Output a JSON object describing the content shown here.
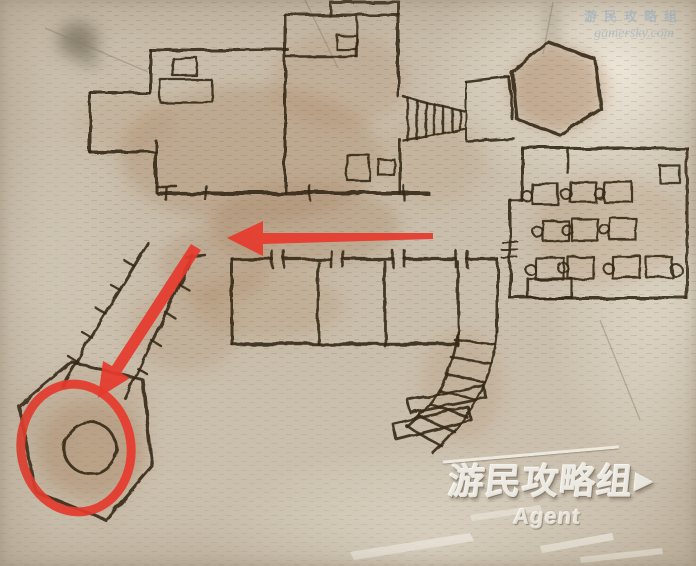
{
  "watermark_top": {
    "line1": "游民攻略组",
    "line2": "gamersky.com"
  },
  "watermark_bottom": {
    "title": "游民攻略组",
    "flag": "▶",
    "subtitle": "Agent"
  },
  "colors": {
    "parchment": "#cbc0ae",
    "ink": "#35281a",
    "stain_brown": "#a37b55",
    "annotation_red": "#e63a2c",
    "watermark_blue": "#94b4cf",
    "watermark_white": "#ece9e1"
  },
  "map": {
    "ink": "#35281a",
    "stains": [
      {
        "cx": 250,
        "cy": 155,
        "rx": 130,
        "ry": 70,
        "c": "#a37b55",
        "o": 0.3
      },
      {
        "cx": 305,
        "cy": 225,
        "rx": 95,
        "ry": 42,
        "c": "#a37b55",
        "o": 0.3
      },
      {
        "cx": 215,
        "cy": 265,
        "rx": 55,
        "ry": 38,
        "c": "#a37b55",
        "o": 0.28
      },
      {
        "cx": 340,
        "cy": 80,
        "rx": 70,
        "ry": 48,
        "c": "#ab835c",
        "o": 0.24
      },
      {
        "cx": 558,
        "cy": 88,
        "rx": 50,
        "ry": 42,
        "c": "#a37b55",
        "o": 0.3
      },
      {
        "cx": 610,
        "cy": 230,
        "rx": 75,
        "ry": 55,
        "c": "#ab835c",
        "o": 0.2
      },
      {
        "cx": 92,
        "cy": 448,
        "rx": 52,
        "ry": 48,
        "c": "#a37b55",
        "o": 0.33
      },
      {
        "cx": 185,
        "cy": 330,
        "rx": 55,
        "ry": 42,
        "c": "#a37b55",
        "o": 0.2
      },
      {
        "cx": 462,
        "cy": 385,
        "rx": 40,
        "ry": 55,
        "c": "#ab835c",
        "o": 0.2
      },
      {
        "cx": 268,
        "cy": 305,
        "rx": 75,
        "ry": 35,
        "c": "#a88058",
        "o": 0.22
      },
      {
        "cx": 125,
        "cy": 122,
        "rx": 48,
        "ry": 32,
        "c": "#ab835c",
        "o": 0.18
      },
      {
        "cx": 430,
        "cy": 160,
        "rx": 55,
        "ry": 45,
        "c": "#b08a62",
        "o": 0.18
      },
      {
        "cx": 78,
        "cy": 40,
        "rx": 20,
        "ry": 18,
        "c": "#6e6556",
        "o": 0.65
      },
      {
        "cx": 90,
        "cy": 60,
        "rx": 9,
        "ry": 7,
        "c": "#6e6556",
        "o": 0.5
      },
      {
        "cx": 551,
        "cy": 25,
        "rx": 6,
        "ry": 26,
        "c": "#7a6d59",
        "o": 0.4
      }
    ],
    "fills": [
      {
        "d": "M548,42 L595,59 L601,109 L560,135 L517,119 L512,72 Z",
        "color": "#a98565",
        "opacity": 0.28
      },
      {
        "d": "M72,362 L143,380 L152,466 L106,520 L36,492 L19,406 Z",
        "color": "#a98565",
        "opacity": 0.22
      }
    ],
    "creases": [
      {
        "d": "M305,0 L338,68"
      },
      {
        "d": "M553,2 L543,54"
      },
      {
        "d": "M45,28 L148,72"
      },
      {
        "d": "M600,320 L640,420"
      }
    ],
    "strokes": [
      {
        "d": "M150,50 L288,50"
      },
      {
        "d": "M150,50 L150,93"
      },
      {
        "d": "M90,93 L150,93"
      },
      {
        "d": "M90,93 L90,152"
      },
      {
        "d": "M90,152 L156,152"
      },
      {
        "d": "M156,141 L156,192"
      },
      {
        "d": "M156,186 L176,186",
        "w": 2.4
      },
      {
        "d": "M285,15 L398,15"
      },
      {
        "d": "M285,15 L285,193"
      },
      {
        "d": "M330,15 L330,2 L399,2 L399,15"
      },
      {
        "d": "M287,57 L357,57",
        "w": 2.6
      },
      {
        "d": "M357,17 L357,57",
        "w": 2.6
      },
      {
        "d": "M398,15 L398,96"
      },
      {
        "d": "M400,140 L400,193"
      },
      {
        "d": "M158,193 L428,193",
        "w": 4
      },
      {
        "d": "M166,186 L166,200",
        "w": 2.4
      },
      {
        "d": "M206,186 L206,200",
        "w": 2.4
      },
      {
        "d": "M310,186 L310,200",
        "w": 2.4
      },
      {
        "d": "M404,186 L404,200",
        "w": 2.4
      },
      {
        "d": "M404,97 L464,111",
        "w": 2.4
      },
      {
        "d": "M404,141 L464,129",
        "w": 2.4
      },
      {
        "d": "M408,98 L408,141",
        "w": 2.4
      },
      {
        "d": "M417,100 L417,139",
        "w": 2.4
      },
      {
        "d": "M426,102 L426,137",
        "w": 2.4
      },
      {
        "d": "M434,104 L434,135",
        "w": 2.4
      },
      {
        "d": "M443,106 L443,133",
        "w": 2.4
      },
      {
        "d": "M452,108 L452,131",
        "w": 2.4
      },
      {
        "d": "M460,110 L460,129",
        "w": 2.4
      },
      {
        "d": "M466,82 L509,77",
        "w": 2.6
      },
      {
        "d": "M509,77 L513,120",
        "w": 2.6
      },
      {
        "d": "M468,141 L513,138",
        "w": 2.6
      },
      {
        "d": "M466,82 L466,141",
        "w": 2
      },
      {
        "d": "M548,42 L595,59 L601,109 L560,135 L517,119 L512,72 Z",
        "w": 3.4
      },
      {
        "d": "M522,148 L687,148"
      },
      {
        "d": "M687,148 L687,298"
      },
      {
        "d": "M510,298 L687,298"
      },
      {
        "d": "M522,148 L522,200"
      },
      {
        "d": "M510,200 L522,200",
        "w": 2.6
      },
      {
        "d": "M510,200 L510,298"
      },
      {
        "d": "M568,148 L568,173",
        "w": 2.6
      },
      {
        "d": "M502,242 L518,242",
        "w": 2
      },
      {
        "d": "M502,250 L518,250",
        "w": 2
      },
      {
        "d": "M502,258 L518,258",
        "w": 2
      },
      {
        "d": "M232,259 L272,259",
        "w": 3.2
      },
      {
        "d": "M284,259 L331,259",
        "w": 3.2
      },
      {
        "d": "M343,259 L393,259",
        "w": 3.2
      },
      {
        "d": "M405,259 L456,259",
        "w": 3.2
      },
      {
        "d": "M467,259 L497,259",
        "w": 3.2
      },
      {
        "d": "M272,251 L272,267",
        "w": 2.6
      },
      {
        "d": "M284,251 L284,267",
        "w": 2.6
      },
      {
        "d": "M331,251 L331,267",
        "w": 2.6
      },
      {
        "d": "M343,251 L343,267",
        "w": 2.6
      },
      {
        "d": "M393,251 L393,267",
        "w": 2.6
      },
      {
        "d": "M405,251 L405,267",
        "w": 2.6
      },
      {
        "d": "M456,251 L456,267",
        "w": 2.6
      },
      {
        "d": "M467,251 L467,267",
        "w": 2.6
      },
      {
        "d": "M232,259 L232,344"
      },
      {
        "d": "M232,344 L458,344",
        "w": 3.4
      },
      {
        "d": "M318,262 L318,344",
        "w": 2.8
      },
      {
        "d": "M385,262 L385,346",
        "w": 2.8
      },
      {
        "d": "M458,262 L458,346",
        "w": 2.8
      },
      {
        "d": "M497,259 L497,332"
      },
      {
        "d": "M458,332 C454,365 441,398 407,427",
        "w": 2.6
      },
      {
        "d": "M497,332 C494,372 477,412 433,453",
        "w": 2.6
      },
      {
        "d": "M455,340 L495,344",
        "w": 2.6
      },
      {
        "d": "M451,357 L491,363",
        "w": 2.6
      },
      {
        "d": "M446,374 L485,382",
        "w": 2.6
      },
      {
        "d": "M439,390 L477,400",
        "w": 2.6
      },
      {
        "d": "M430,404 L467,417",
        "w": 2.6
      },
      {
        "d": "M419,416 L455,432",
        "w": 2.6
      },
      {
        "d": "M407,426 L441,446",
        "w": 2.6
      },
      {
        "d": "M408,400 L483,385 L486,398 L411,413 Z",
        "w": 2.8
      },
      {
        "d": "M393,424 L468,407 L471,420 L396,439 Z",
        "w": 2.8
      },
      {
        "d": "M148,243 L62,386",
        "w": 3
      },
      {
        "d": "M134,266 L124,260",
        "w": 2.4
      },
      {
        "d": "M120,290 L110,284",
        "w": 2.4
      },
      {
        "d": "M106,314 L96,308",
        "w": 2.4
      },
      {
        "d": "M92,338 L82,332",
        "w": 2.4
      },
      {
        "d": "M78,362 L68,356",
        "w": 2.4
      },
      {
        "d": "M193,256 L125,398",
        "w": 3
      },
      {
        "d": "M179,284 L189,290",
        "w": 2.4
      },
      {
        "d": "M165,312 L175,318",
        "w": 2.4
      },
      {
        "d": "M151,340 L161,346",
        "w": 2.4
      },
      {
        "d": "M137,368 L147,374",
        "w": 2.4
      },
      {
        "d": "M186,258 L206,256",
        "w": 2.4
      },
      {
        "d": "M72,362 L143,380 L152,466 L106,520 L36,492 L19,406 Z",
        "w": 3.2
      }
    ],
    "rects": [
      {
        "x": 173,
        "y": 58,
        "w": 24,
        "h": 18
      },
      {
        "x": 160,
        "y": 80,
        "w": 52,
        "h": 22
      },
      {
        "x": 337,
        "y": 35,
        "w": 20,
        "h": 15
      },
      {
        "x": 347,
        "y": 155,
        "w": 22,
        "h": 25
      },
      {
        "x": 378,
        "y": 159,
        "w": 16,
        "h": 16
      },
      {
        "x": 532,
        "y": 184,
        "w": 26,
        "h": 20
      },
      {
        "x": 570,
        "y": 182,
        "w": 26,
        "h": 20
      },
      {
        "x": 604,
        "y": 182,
        "w": 28,
        "h": 20
      },
      {
        "x": 660,
        "y": 166,
        "w": 20,
        "h": 17
      },
      {
        "x": 543,
        "y": 221,
        "w": 26,
        "h": 20
      },
      {
        "x": 572,
        "y": 219,
        "w": 26,
        "h": 22
      },
      {
        "x": 610,
        "y": 218,
        "w": 26,
        "h": 22
      },
      {
        "x": 536,
        "y": 258,
        "w": 28,
        "h": 22
      },
      {
        "x": 568,
        "y": 257,
        "w": 26,
        "h": 22
      },
      {
        "x": 612,
        "y": 256,
        "w": 28,
        "h": 22
      },
      {
        "x": 646,
        "y": 257,
        "w": 26,
        "h": 20
      },
      {
        "x": 528,
        "y": 279,
        "w": 44,
        "h": 19
      }
    ],
    "circles": [
      {
        "cx": 90,
        "cy": 448,
        "r": 26,
        "w": 2.8
      },
      {
        "cx": 527,
        "cy": 196,
        "r": 5
      },
      {
        "cx": 566,
        "cy": 194,
        "r": 5
      },
      {
        "cx": 600,
        "cy": 194,
        "r": 5
      },
      {
        "cx": 538,
        "cy": 232,
        "r": 5
      },
      {
        "cx": 567,
        "cy": 230,
        "r": 5
      },
      {
        "cx": 605,
        "cy": 230,
        "r": 5
      },
      {
        "cx": 531,
        "cy": 270,
        "r": 5
      },
      {
        "cx": 563,
        "cy": 268,
        "r": 5
      },
      {
        "cx": 608,
        "cy": 268,
        "r": 5
      },
      {
        "cx": 676,
        "cy": 270,
        "r": 6
      }
    ],
    "tears": [
      {
        "d": "M350,552 L470,533 L474,541 L354,560 Z",
        "o": 0.8
      },
      {
        "d": "M540,546 L612,533 L614,540 L542,553 Z",
        "o": 0.75
      },
      {
        "d": "M580,557 L662,548 L663,554 L581,563 Z",
        "o": 0.7
      },
      {
        "d": "M470,515 L540,505 L542,511 L472,521 Z",
        "o": 0.5
      }
    ]
  },
  "annotations": {
    "color": "#e63a2c",
    "arrows": [
      {
        "name": "red-arrow-horizontal",
        "points": "227,238 263,221 263,233 433,233 433,239 263,244 263,256"
      },
      {
        "name": "red-arrow-diagonal",
        "points": "98,398 103,361 112,366 191,244 201,250 121,373 130,378"
      }
    ],
    "ellipse": {
      "cx": 76,
      "cy": 448,
      "rx": 55,
      "ry": 64,
      "sw": 9,
      "rot": -8
    }
  }
}
